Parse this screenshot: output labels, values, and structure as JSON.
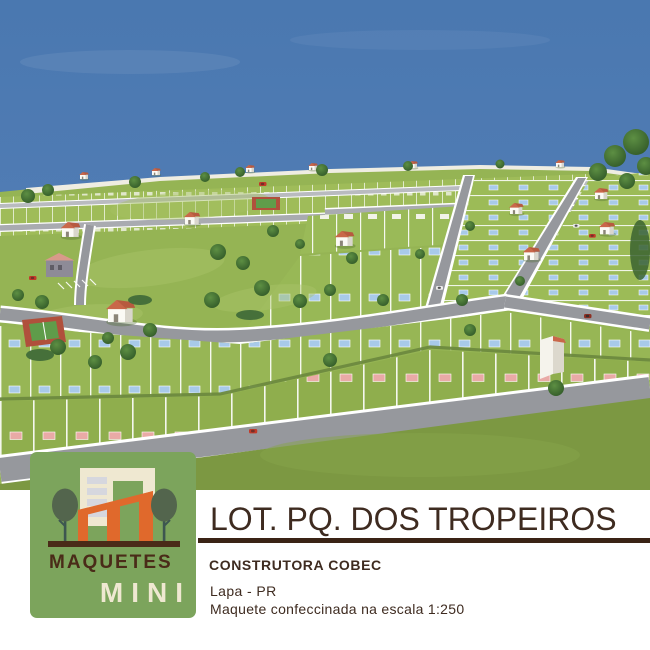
{
  "brand": {
    "word_top": "MAQUETES",
    "word_bottom": "MINI"
  },
  "project": {
    "title": "LOT. PQ. DOS TROPEIROS",
    "client": "CONSTRUTORA COBEC",
    "location": "Lapa - PR",
    "scale_note": "Maquete confeccinada na escala 1:250"
  },
  "colors": {
    "logo_green": "#7ca45c",
    "logo_orange": "#e0692c",
    "logo_cream": "#efe8d1",
    "logo_brown": "#4a2b18",
    "text_brown": "#3e2b20",
    "panel_white": "#ffffff",
    "sky_top": "#4a78b0",
    "sky_horizon": "#6b93c5",
    "grass_light": "#9fbc59",
    "grass_mid": "#95b454",
    "grass_dark": "#7c9842",
    "road_gray": "#96989d",
    "road_edge": "#ffffff",
    "roof_terracotta": "#c9674a",
    "wall_white": "#f1efe5",
    "plaque_blue": "#a8cae9",
    "plaque_pink": "#e9aaa6",
    "tree_dark": "#3f6b34"
  }
}
